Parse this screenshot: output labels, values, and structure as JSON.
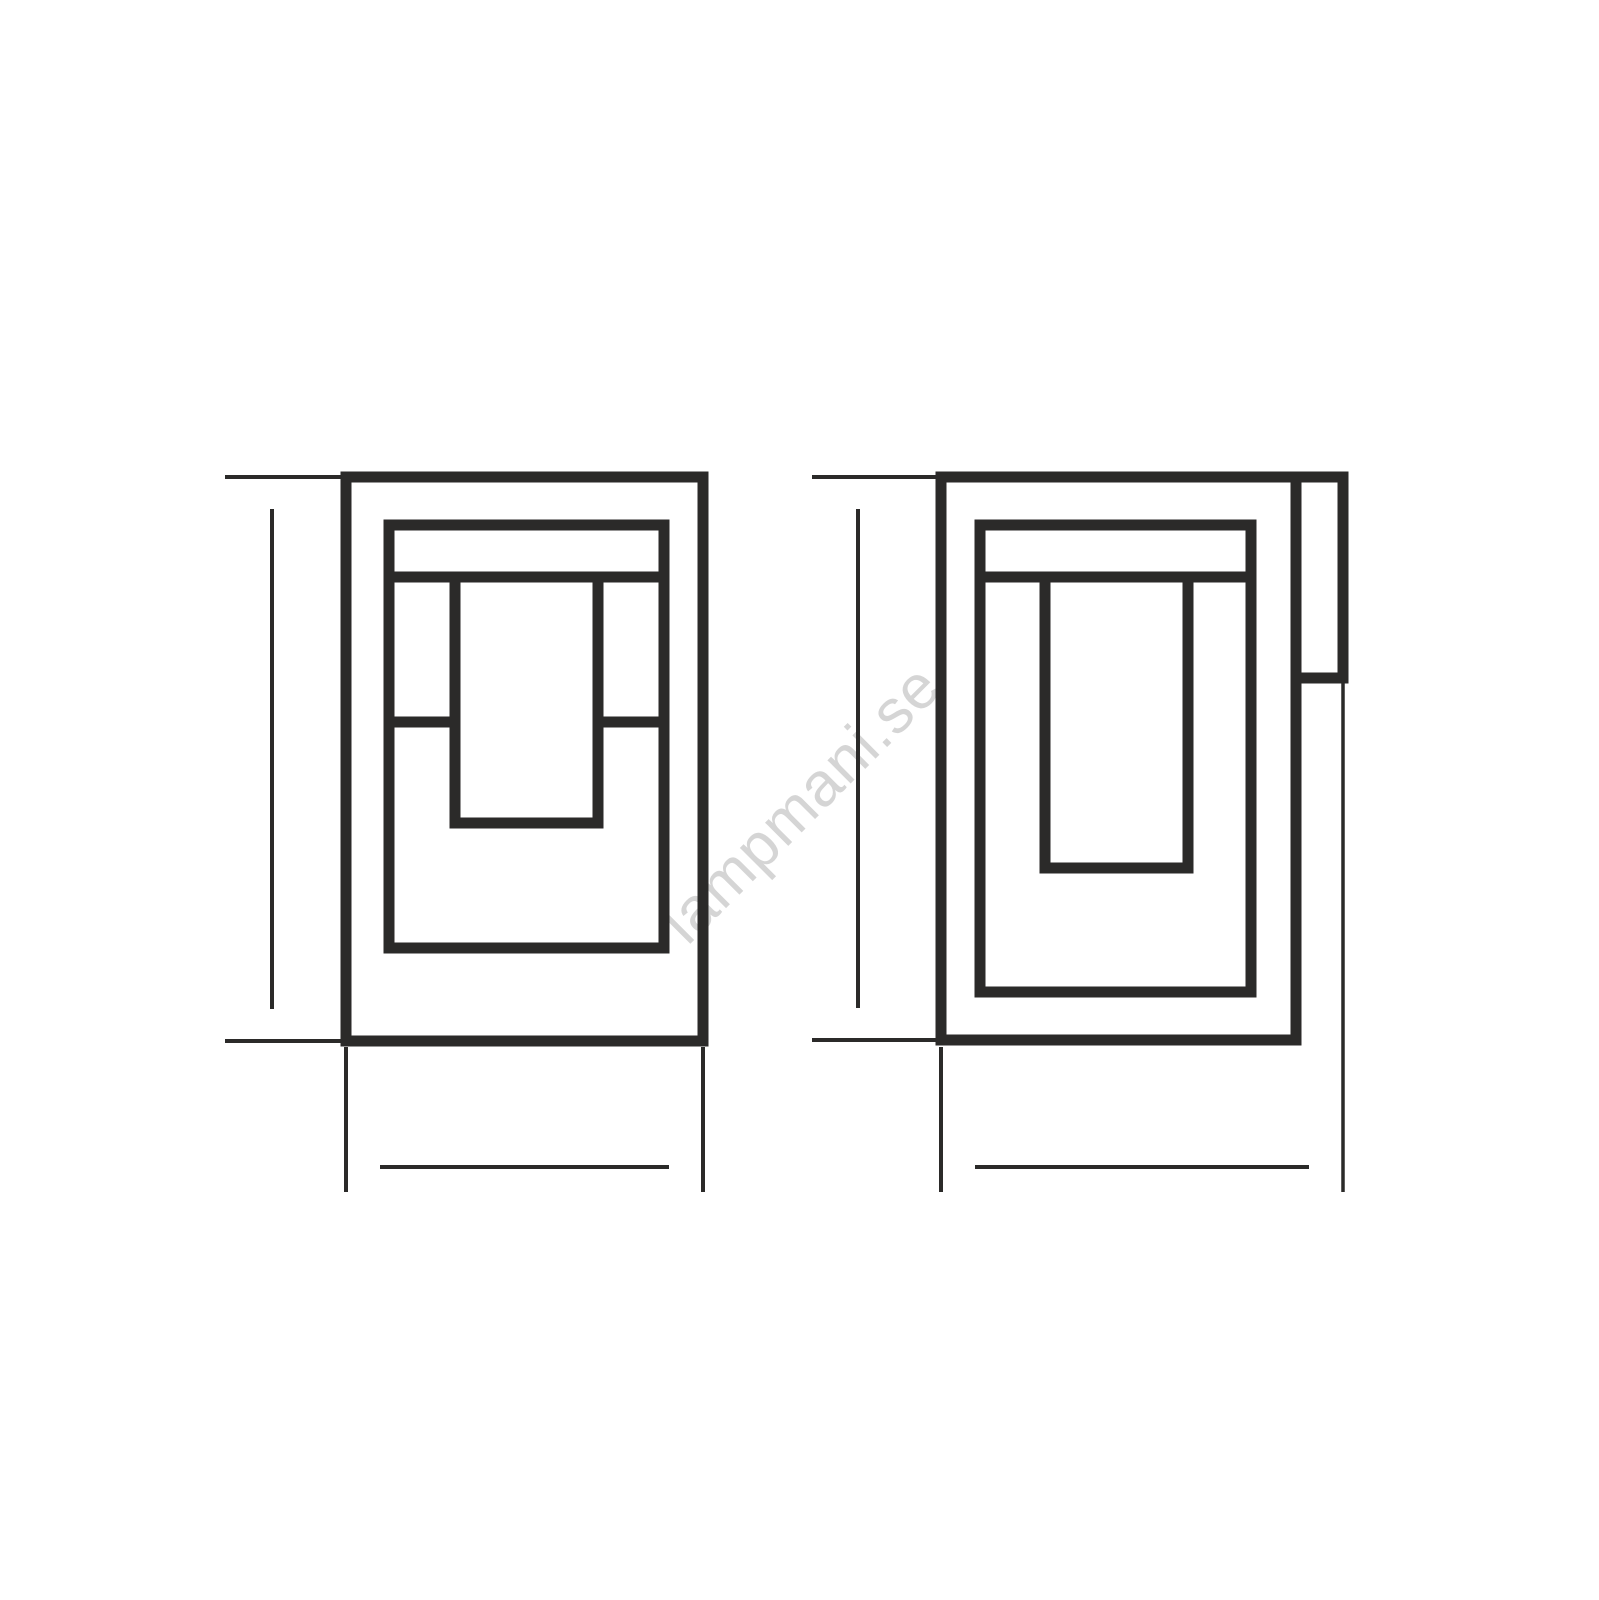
{
  "drawing": {
    "watermark": "lampmani.se",
    "views": {
      "front": {
        "height_label": "270",
        "width_label": "150"
      },
      "side": {
        "height_label": "270",
        "width_label": "165"
      }
    }
  },
  "colors": {
    "line": "#2b2a29",
    "dimension": "#2b2a29",
    "watermark": "#d5d5d5",
    "background": "#ffffff"
  }
}
